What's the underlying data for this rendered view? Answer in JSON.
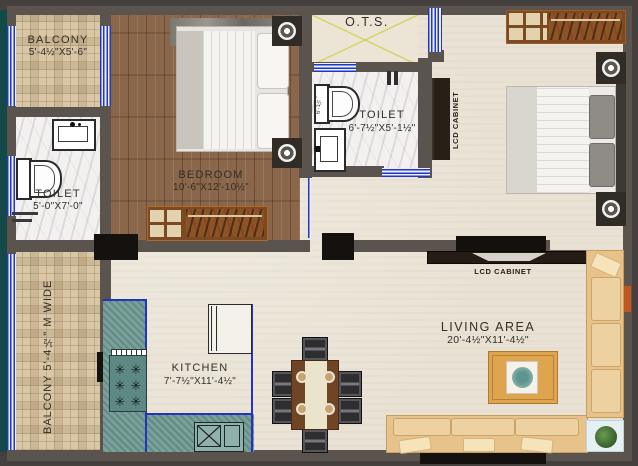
{
  "unit": {
    "number": "4"
  },
  "rooms": {
    "balcony_top": {
      "name": "BALCONY",
      "dim": "5'-4½\"X5'-6\""
    },
    "toilet_1": {
      "name": "TOILET",
      "dim": "5'-0\"X7'-0\""
    },
    "bedroom": {
      "name": "BEDROOM",
      "dim": "10'-6\"X12'-10½\""
    },
    "ots": {
      "name": "O.T.S."
    },
    "toilet_2": {
      "name": "TOILET",
      "dim": "6'-7½\"X5'-1½\"",
      "side_dim": "6'-1½\""
    },
    "balcony_left": {
      "name": "BALCONY 5'-4½\" M WIDE"
    },
    "kitchen": {
      "name": "KITCHEN",
      "dim": "7'-7½\"X11'-4½\""
    },
    "living": {
      "name": "LIVING AREA",
      "dim": "20'-4½\"X11'-4½\""
    }
  },
  "cabinets": {
    "bedroom_lcd": "LCD CABINET",
    "living_lcd": "LCD CABINET"
  },
  "icons": {
    "burner_glyph": "✳"
  },
  "colors": {
    "wall": "#5b534d",
    "background": "#45403d",
    "window_blue": "#1d35c8",
    "floor_cream": "#e9e2d4",
    "bedroom_wood": "#8a674a",
    "balcony_tile": "#d9c7a6",
    "toilet_marble": "#f3f1ef",
    "kitchen_counter_teal": "#79a09a",
    "sofa_tan": "#e8c28b",
    "rug_orange": "#dfa44e",
    "unit_badge_red": "#e62525",
    "ots_cross_yellow": "#d3d463"
  }
}
